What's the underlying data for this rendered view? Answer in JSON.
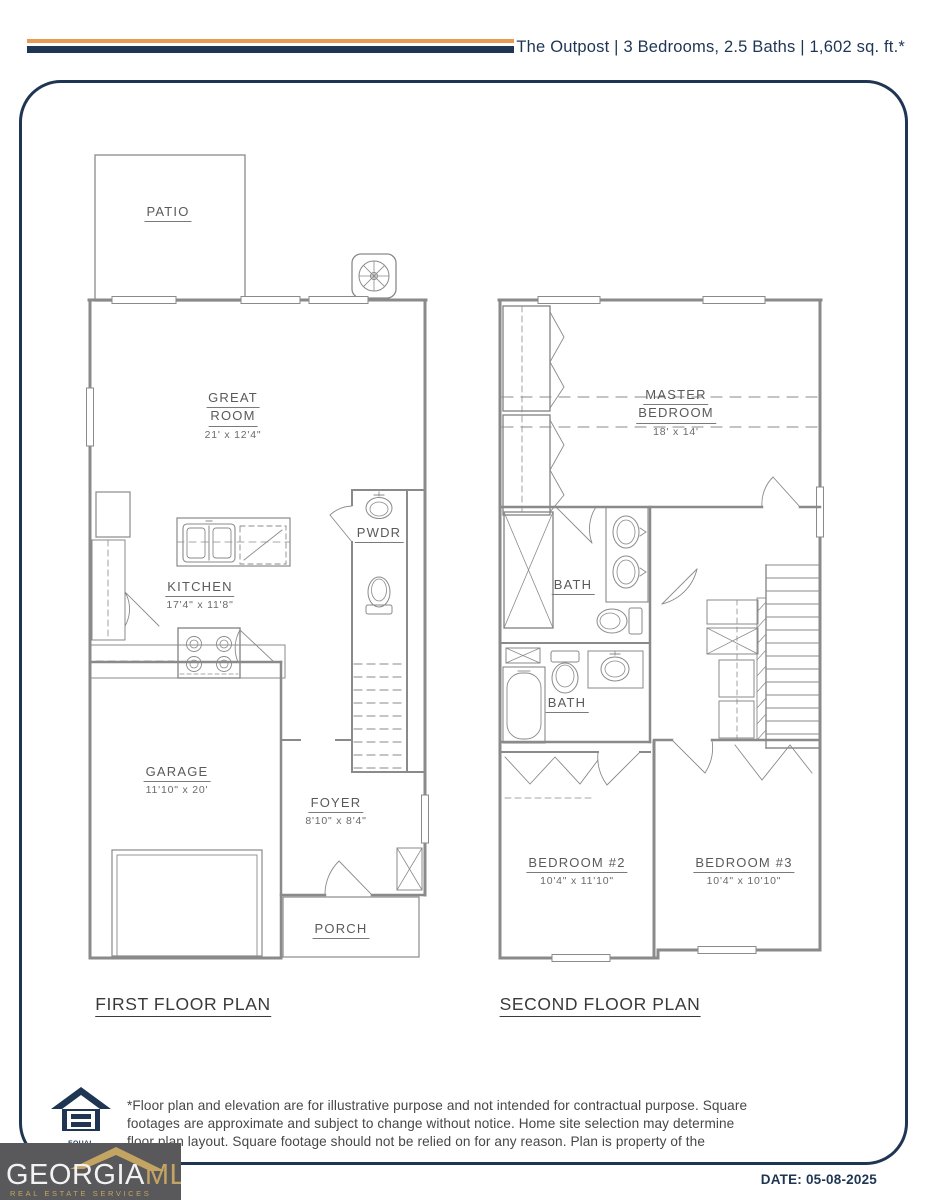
{
  "header": {
    "title": "The Outpost | 3 Bedrooms, 2.5 Baths | 1,602 sq. ft.*"
  },
  "first_floor": {
    "title": "FIRST FLOOR PLAN",
    "patio": "PATIO",
    "great_room": {
      "l1": "GREAT",
      "l2": "ROOM",
      "dims": "21' x 12'4\""
    },
    "kitchen": {
      "label": "KITCHEN",
      "dims": "17'4\" x 11'8\""
    },
    "pwdr": "PWDR",
    "garage": {
      "label": "GARAGE",
      "dims": "11'10\" x 20'"
    },
    "foyer": {
      "label": "FOYER",
      "dims": "8'10\" x 8'4\""
    },
    "porch": "PORCH"
  },
  "second_floor": {
    "title": "SECOND FLOOR PLAN",
    "master": {
      "l1": "MASTER",
      "l2": "BEDROOM",
      "dims": "18' x 14'"
    },
    "bath_master": "BATH",
    "bath_hall": "BATH",
    "bedroom2": {
      "label": "BEDROOM #2",
      "dims": "10'4\" x 11'10\""
    },
    "bedroom3": {
      "label": "BEDROOM #3",
      "dims": "10'4\" x 10'10\""
    }
  },
  "footer": {
    "disclaimer": "*Floor plan and elevation are for illustrative purpose and not intended for contractual purpose. Square footages are approximate and subject to change without notice. Home site selection may determine floor plan layout. Square footage should not be relied on for any reason. Plan is property of the",
    "equal_housing": "EQUAL HOUSING",
    "brand": {
      "name_primary": "GEORGIA",
      "name_secondary": "MLS",
      "tagline": "REAL ESTATE SERVICES"
    },
    "date": "DATE: 05-08-2025"
  },
  "colors": {
    "navy": "#1e3553",
    "orange": "#e89a52",
    "gold": "#c4a462",
    "logo_background": "#59595b",
    "plan_lines": "#8a8a8a"
  }
}
